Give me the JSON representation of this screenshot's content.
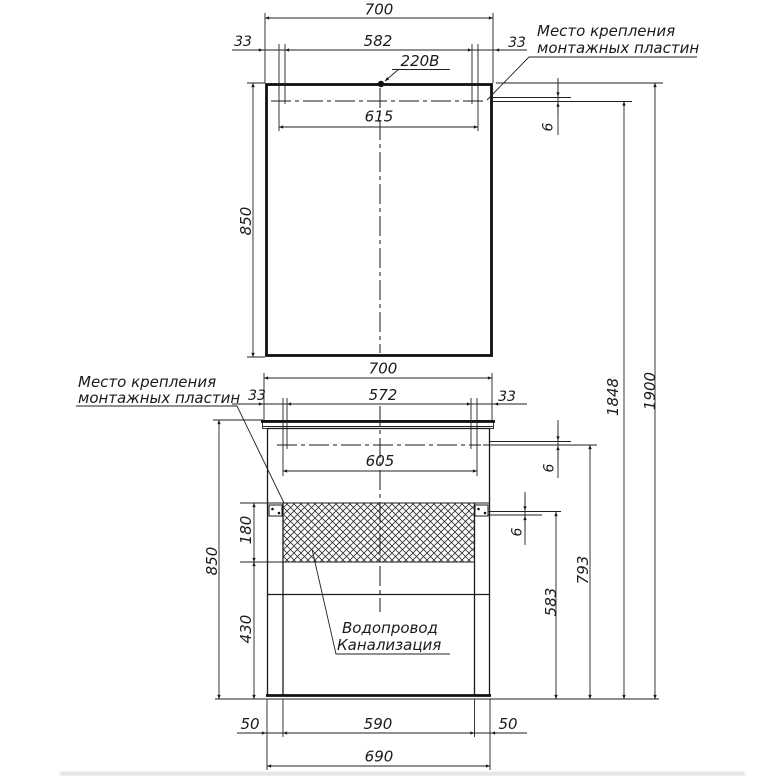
{
  "annotations": {
    "power_outlet": "220В",
    "mounting_top": {
      "line1": "Место крепления",
      "line2": "монтажных пластин"
    },
    "mounting_middle": {
      "line1": "Место крепления",
      "line2": "монтажных пластин"
    },
    "plumbing": {
      "line1": "Водопровод",
      "line2": "Канализация"
    }
  },
  "dims": {
    "mirror": {
      "width": "700",
      "offset_left": "33",
      "plate_span_inner": "582",
      "offset_right": "33",
      "plate_span_outer": "615",
      "height": "850",
      "plate_inset": "6"
    },
    "cabinet": {
      "width": "700",
      "offset_left": "33",
      "plate_span_inner": "572",
      "offset_right": "33",
      "plate_span_outer": "605",
      "height": "850",
      "plate_inset": "6",
      "service_zone_height": "180",
      "lower_zone_height": "430",
      "hatch_plate_inset": "6"
    },
    "vertical": {
      "floor_to_hatch_plates": "583",
      "floor_to_cabinet_plates": "793",
      "floor_to_mirror_plates": "1848",
      "floor_to_mirror_top": "1900"
    },
    "base": {
      "left_inset": "50",
      "leg_span": "590",
      "right_inset": "50",
      "overall_width": "690"
    }
  }
}
